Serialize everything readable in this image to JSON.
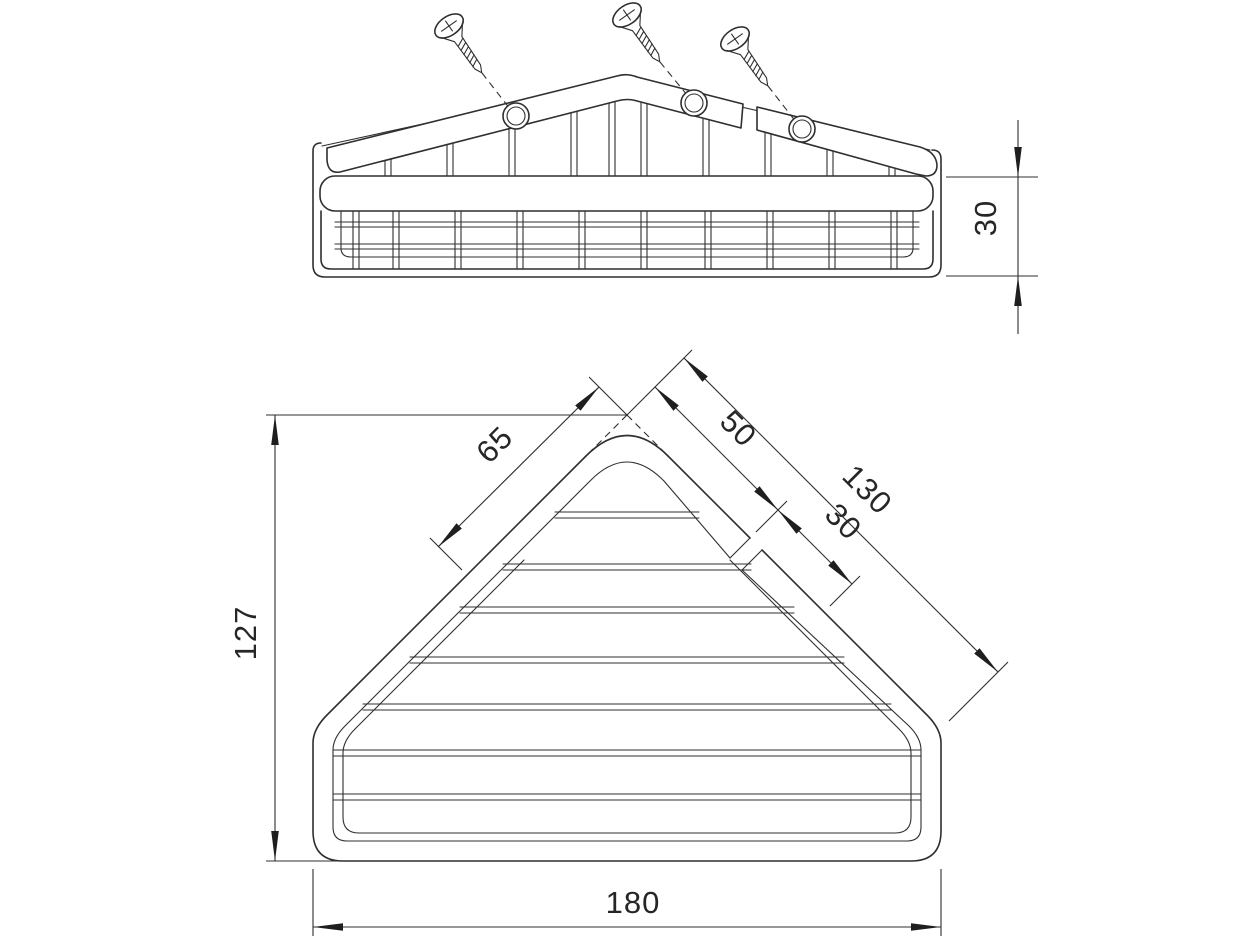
{
  "drawing": {
    "title": "corner-basket-technical-drawing",
    "colors": {
      "line": "#2f2f2f",
      "background": "#ffffff",
      "arrow": "#1f1f1f"
    },
    "views": {
      "side_view": {
        "dimensions": {
          "height": "30"
        },
        "screw_count": 3,
        "screw_hole_count": 3
      },
      "plan_view": {
        "dimensions": {
          "left_rail_length": "65",
          "right_rail_first": "50",
          "right_rail_second": "30",
          "right_slope_total": "130",
          "depth": "127",
          "width": "180"
        }
      }
    }
  }
}
